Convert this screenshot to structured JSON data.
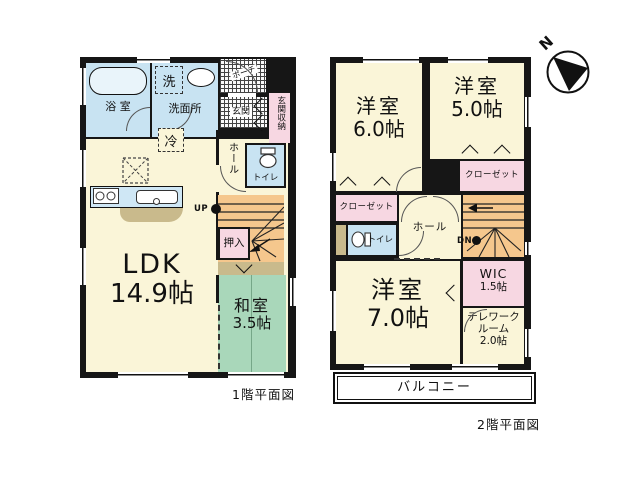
{
  "compass": {
    "north_label": "N"
  },
  "floor1": {
    "caption": "1階平面図",
    "rooms": {
      "ldk": {
        "name": "LDK",
        "size": "14.9帖"
      },
      "washitsu": {
        "name": "和室",
        "size": "3.5帖"
      },
      "bath": {
        "name": "浴 室"
      },
      "washroom": {
        "name": "洗面所"
      },
      "laundry": {
        "name": "洗"
      },
      "fridge": {
        "name": "冷"
      },
      "porch": {
        "name": "ポーチ"
      },
      "genkan": {
        "name": "玄関"
      },
      "genkan_storage": {
        "name": "玄関収納"
      },
      "hall": {
        "name": "ホール"
      },
      "toilet": {
        "name": "トイレ"
      },
      "oshiire": {
        "name": "押入"
      },
      "stairs_up": {
        "label": "UP"
      }
    }
  },
  "floor2": {
    "caption": "2階平面図",
    "rooms": {
      "yoshitsu6": {
        "name": "洋室",
        "size": "6.0帖"
      },
      "yoshitsu5": {
        "name": "洋室",
        "size": "5.0帖"
      },
      "yoshitsu7": {
        "name": "洋室",
        "size": "7.0帖"
      },
      "closet_left": {
        "name": "クローゼット"
      },
      "closet_right": {
        "name": "クローゼット"
      },
      "hall": {
        "name": "ホール"
      },
      "toilet": {
        "name": "トイレ"
      },
      "wic": {
        "name": "WIC",
        "size": "1.5帖"
      },
      "telework": {
        "line1": "テレワーク",
        "line2": "ルーム",
        "size": "2.0帖"
      },
      "balcony": {
        "name": "バルコニー"
      },
      "stairs_down": {
        "label": "DN"
      }
    }
  },
  "colors": {
    "wall": "#161616",
    "room_cream": "#FAF5D8",
    "water_blue": "#C8E3F2",
    "tatami_green": "#A9D7BA",
    "stairs_orange": "#F5C78D",
    "closet_pink": "#F7D7E2",
    "counter_tan": "#C9BA8C"
  }
}
